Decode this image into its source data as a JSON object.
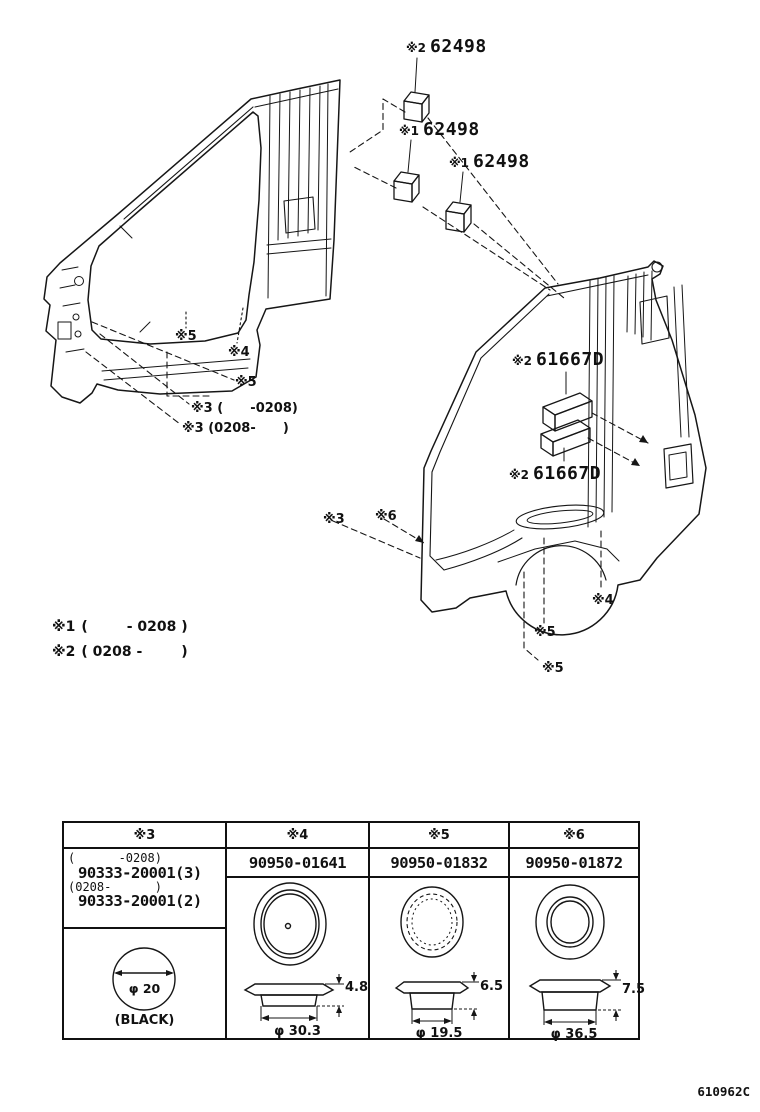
{
  "page": {
    "doc_number": "610962C"
  },
  "callouts": [
    {
      "prefix": "※2",
      "part": "62498"
    },
    {
      "prefix": "※1",
      "part": "62498"
    },
    {
      "prefix": "※1",
      "part": "62498"
    },
    {
      "prefix": "※2",
      "part": "61667D"
    },
    {
      "prefix": "※2",
      "part": "61667D"
    }
  ],
  "markers": [
    {
      "label": "※5"
    },
    {
      "label": "※4"
    },
    {
      "label": "※5"
    },
    {
      "label": "※3 (      -0208)"
    },
    {
      "label": "※3 (0208-      )"
    },
    {
      "label": "※3"
    },
    {
      "label": "※6"
    },
    {
      "label": "※4"
    },
    {
      "label": "※5"
    },
    {
      "label": "※5"
    }
  ],
  "legend": {
    "line1": {
      "marker": "※1",
      "range": "(        - 0208 )"
    },
    "line2": {
      "marker": "※2",
      "range": "( 0208 -        )"
    }
  },
  "table": {
    "columns": [
      {
        "header": "※3",
        "cell_lines": [
          "(      -0208)",
          "90333-20001(3)",
          "(0208-      )",
          "90333-20001(2)"
        ],
        "diameter": "φ 20",
        "note": "(BLACK)"
      },
      {
        "header": "※4",
        "part_number": "90950-01641",
        "height": "4.8",
        "diameter": "φ 30.3"
      },
      {
        "header": "※5",
        "part_number": "90950-01832",
        "height": "6.5",
        "diameter": "φ 19.5"
      },
      {
        "header": "※6",
        "part_number": "90950-01872",
        "height": "7.5",
        "diameter": "φ 36.5"
      }
    ]
  }
}
